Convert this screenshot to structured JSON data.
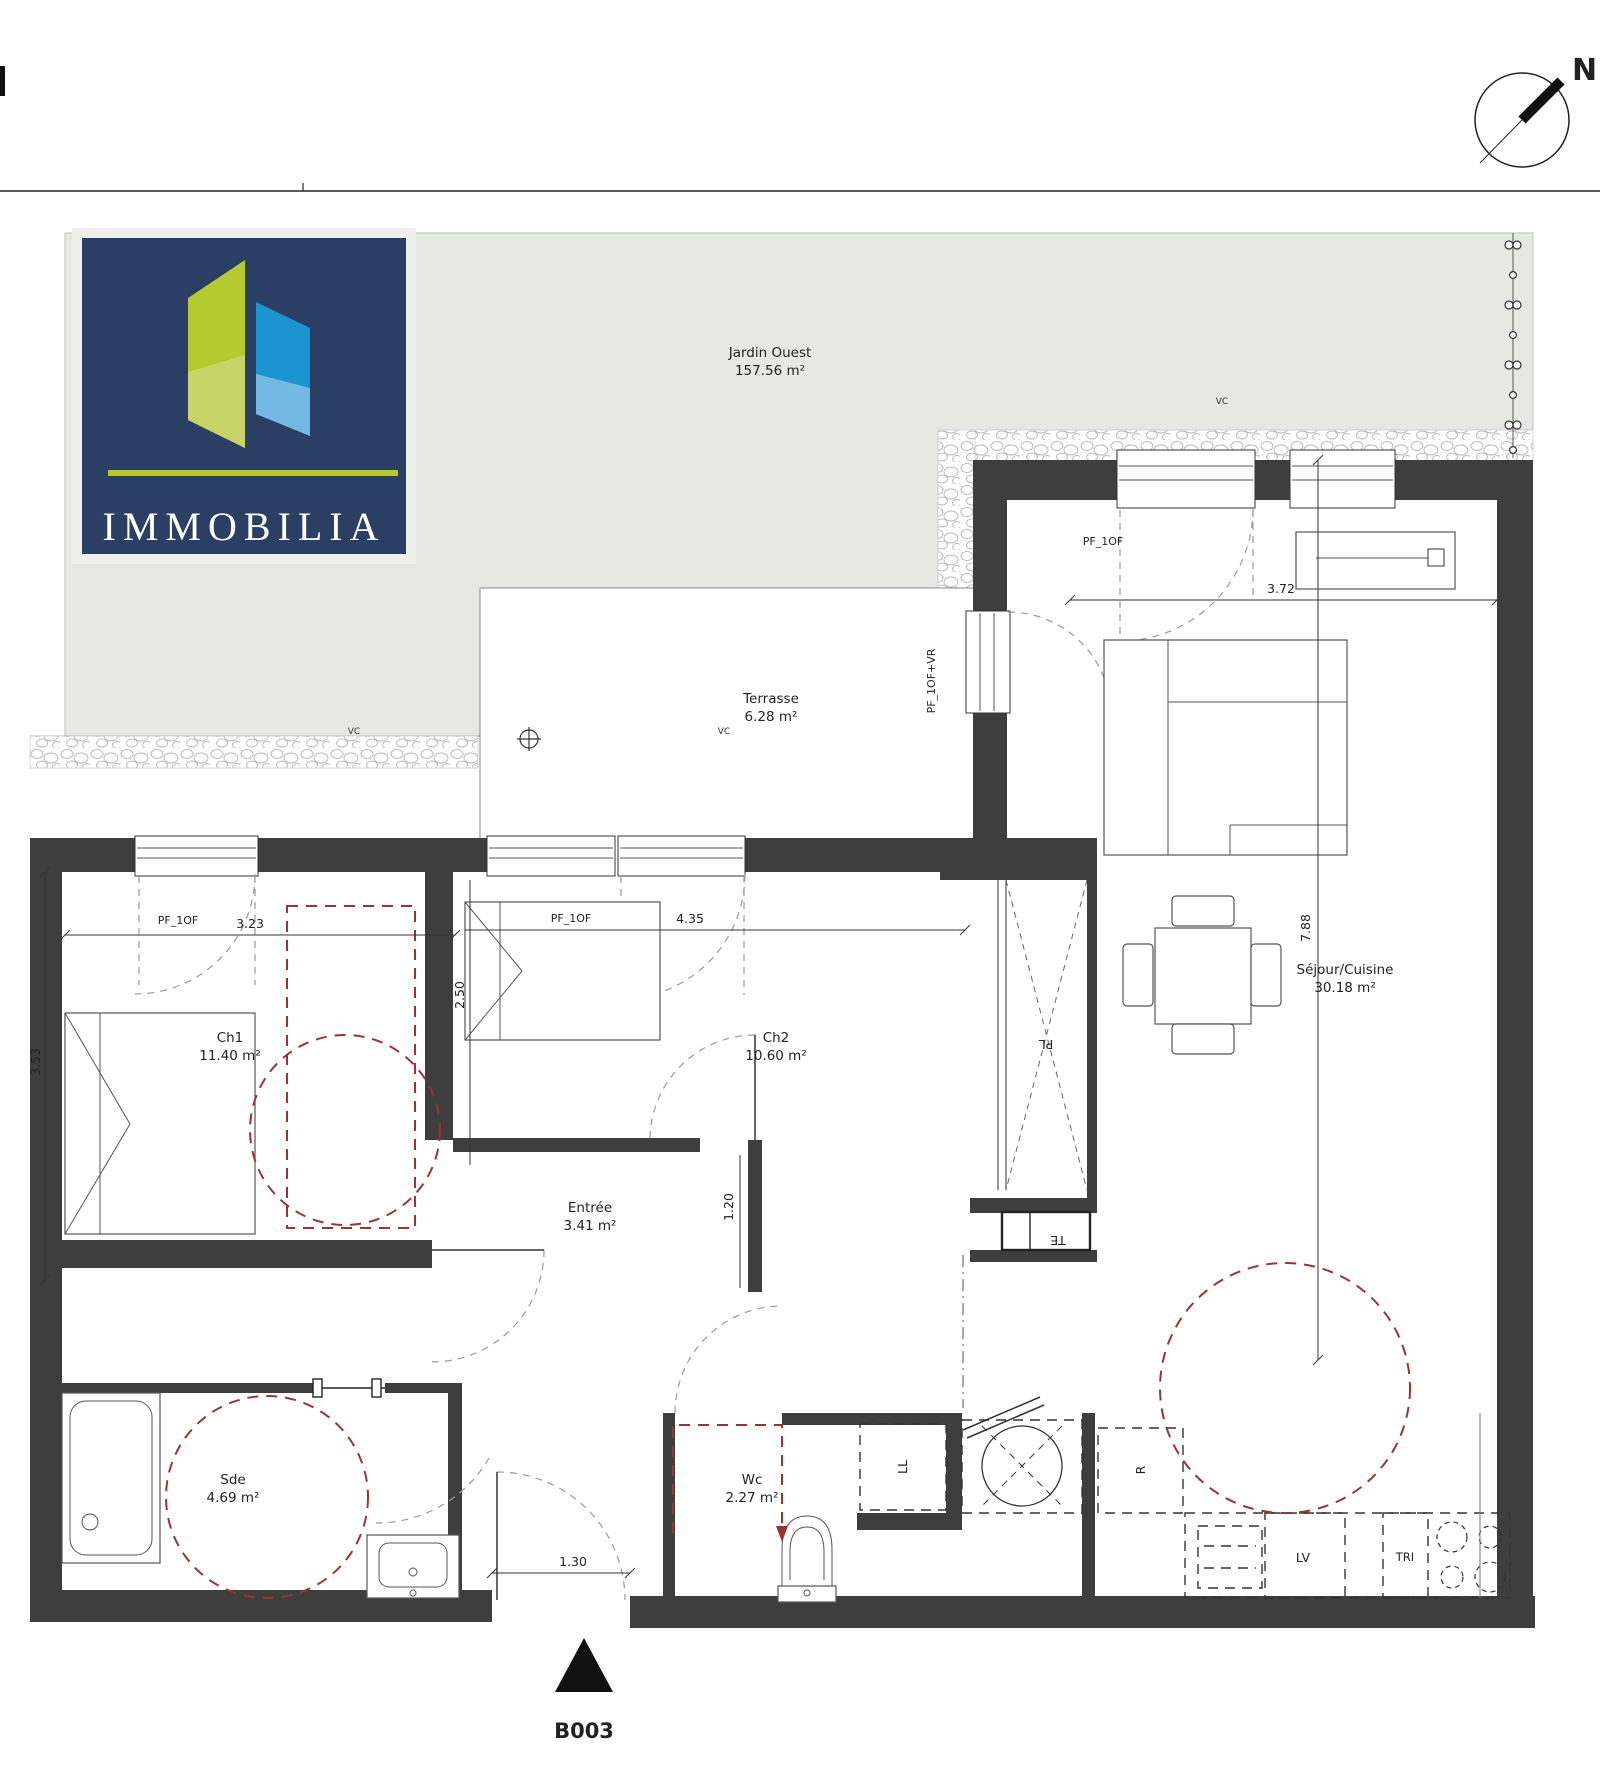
{
  "plan": {
    "unit": "B003",
    "compass_label": "N",
    "logo": {
      "brand": "IMMOBILIA"
    },
    "rooms": {
      "jardin": {
        "name": "Jardin Ouest",
        "area": "157.56 m²"
      },
      "terrasse": {
        "name": "Terrasse",
        "area": "6.28 m²"
      },
      "ch1": {
        "name": "Ch1",
        "area": "11.40 m²"
      },
      "ch2": {
        "name": "Ch2",
        "area": "10.60 m²"
      },
      "sejour": {
        "name": "Séjour/Cuisine",
        "area": "30.18 m²"
      },
      "sde": {
        "name": "Sde",
        "area": "4.69 m²"
      },
      "wc": {
        "name": "Wc",
        "area": "2.27 m²"
      },
      "entree": {
        "name": "Entrée",
        "area": "3.41 m²"
      }
    },
    "dimensions": {
      "ch1_width": "3.23",
      "ch2_width": "4.35",
      "sejour_width": "3.72",
      "ch1_depth": "3.53",
      "ch2_depth": "2.50",
      "hall_width": "1.20",
      "entry_width": "1.30",
      "sejour_depth": "7.88"
    },
    "annotations": {
      "pf_1of": "PF_1OF",
      "door_vr": "PF_1OF+VR",
      "vc": "VC",
      "te": "TE",
      "pl": "PL",
      "lv": "LV",
      "tri": "TRI",
      "fridge": "R",
      "washer": "LL"
    },
    "colors": {
      "wall": "#3e3e3e",
      "garden": "#e4eae2",
      "accent_red": "#9b3333",
      "logo_navy": "#2b3e63",
      "logo_lime": "#b5ca2e",
      "logo_blue": "#1d94d2"
    }
  }
}
